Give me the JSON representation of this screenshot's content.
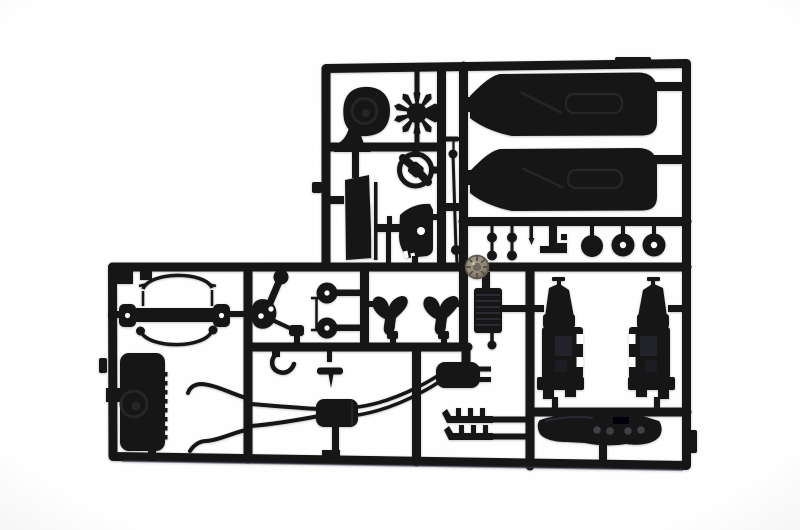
{
  "scene": {
    "type": "photograph",
    "subject": "Black plastic model-kit sprue (injection-moulded parts runner) photographed on a plain white background; L-shaped runner with car model parts in silhouette",
    "colors": {
      "background": "#ffffff",
      "plastic": "#131317",
      "plastic_highlight": "#2a2a31",
      "recess": "#24242b",
      "metal_screw": "#8e8577",
      "metal_screw_dark": "#5a5447",
      "bottom_sheen": "#3b424e",
      "white_cutout": "#ffffff"
    },
    "parts_inventory": [
      {
        "id": "blower-housing",
        "desc": "spiral blower / air-cleaner housing"
      },
      {
        "id": "cooling-fan",
        "desc": "ten-blade radiator fan"
      },
      {
        "id": "steering-wheel",
        "desc": "steering wheel with twin spokes"
      },
      {
        "id": "seat-backrest",
        "desc": "seat backrest panel"
      },
      {
        "id": "seat-shell",
        "desc": "seat shell with locating hole"
      },
      {
        "id": "pedal-bar",
        "desc": "pedal / lever cross-bar"
      },
      {
        "id": "tie-rod",
        "desc": "thin tie rod with ball ends"
      },
      {
        "id": "door-panel-upper",
        "desc": "interior door card (upper)"
      },
      {
        "id": "door-panel-lower",
        "desc": "interior door card (lower)"
      },
      {
        "id": "knob-pins",
        "desc": "four small knob pins"
      },
      {
        "id": "needle-pin",
        "desc": "tapered pin"
      },
      {
        "id": "lever-bracket",
        "desc": "stepped lever bracket"
      },
      {
        "id": "pulley-solid",
        "desc": "solid pulley disc"
      },
      {
        "id": "brake-discs",
        "desc": "two discs with centre holes"
      },
      {
        "id": "metal-screw",
        "desc": "knurled metal screw head lying on the runner"
      },
      {
        "id": "front-bar-assembly",
        "desc": "axle/bumper bar with drilled end plates and two curved hoses"
      },
      {
        "id": "suspension-upright",
        "desc": "linkage with ball joint and drilled pads"
      },
      {
        "id": "pulleys-pair",
        "desc": "two small pulleys with holes"
      },
      {
        "id": "shift-rod",
        "desc": "tiny rod with T ends"
      },
      {
        "id": "wishbones",
        "desc": "two Y-shaped control arms"
      },
      {
        "id": "oil-cooler",
        "desc": "ribbed cooler with mushroom pin"
      },
      {
        "id": "engine-units",
        "desc": "two engine/gearbox assemblies"
      },
      {
        "id": "fuel-tank",
        "desc": "fuel tank with filler cap and ribbed edge"
      },
      {
        "id": "exhaust-downpipes",
        "desc": "Y twin downpipes with open tips"
      },
      {
        "id": "muffler-centre",
        "desc": "centre silencer box"
      },
      {
        "id": "muffler-rear",
        "desc": "rear silencer with twin tailpipes"
      },
      {
        "id": "exhaust-headers",
        "desc": "two finned header pipes"
      },
      {
        "id": "hook-pipe",
        "desc": "small J-shaped pipe"
      },
      {
        "id": "wing-bolt",
        "desc": "small winged bolt"
      },
      {
        "id": "dashboard-valance",
        "desc": "dashboard / valance strip with gauge holes"
      }
    ]
  }
}
